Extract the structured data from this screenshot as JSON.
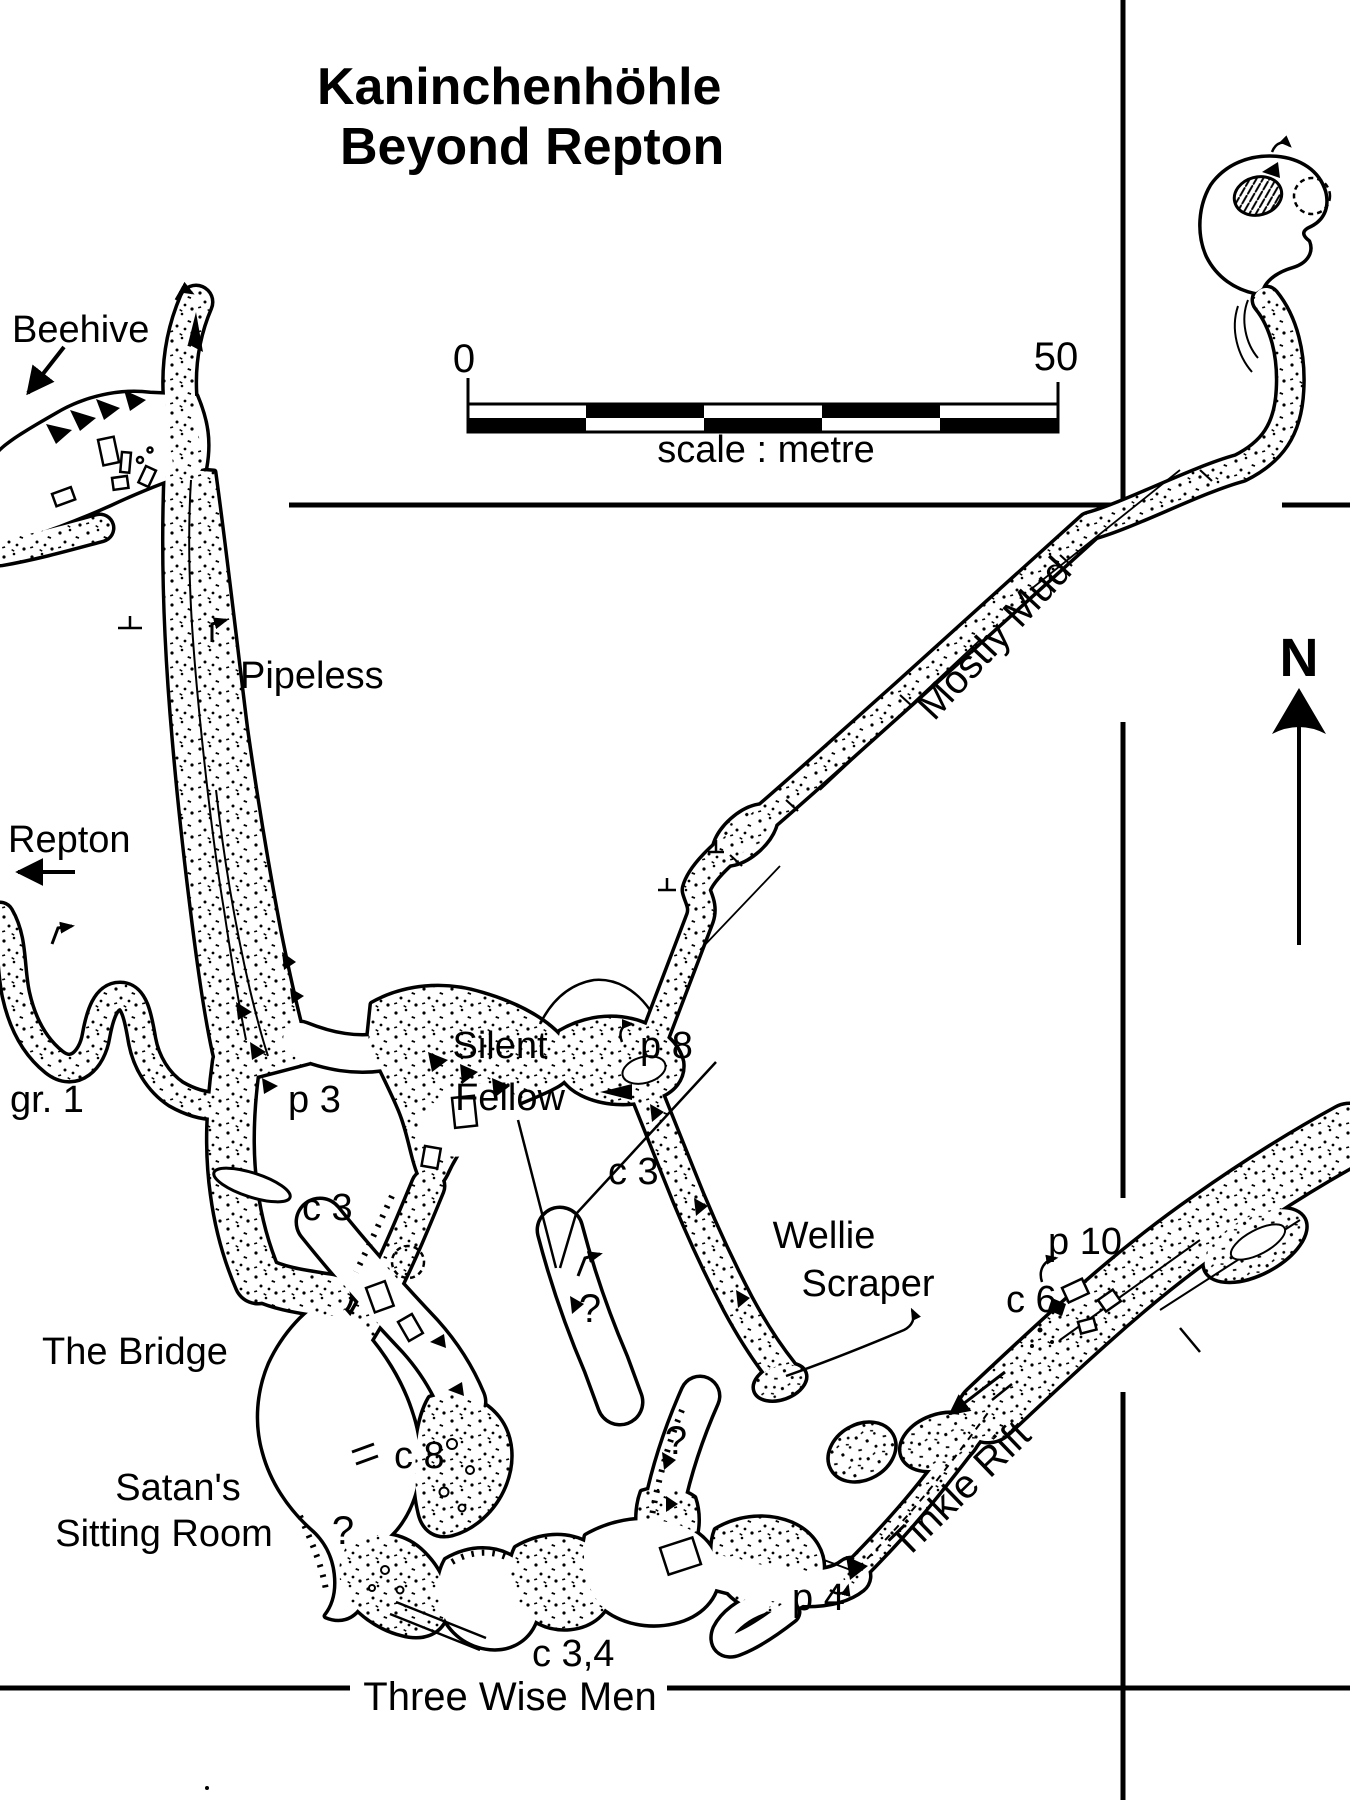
{
  "title": {
    "line1": "Kaninchenhöhle",
    "line2": "Beyond Repton"
  },
  "scale_bar": {
    "start": "0",
    "end": "50",
    "caption": "scale : metre"
  },
  "compass": {
    "label": "N"
  },
  "colors": {
    "ink": "#000000",
    "paper": "#ffffff"
  },
  "labels": {
    "beehive": "Beehive",
    "repton": "Repton",
    "pipeless": "Pipeless",
    "gr1": "gr. 1",
    "p3": "p 3",
    "c3_upper": "c 3",
    "silent_1": "Silent",
    "silent_2": "Fellow",
    "p8": "p 8",
    "c3_silent": "c 3",
    "mostly_mud": "Mostly Mud",
    "wellie_1": "Wellie",
    "wellie_2": "Scraper",
    "p10": "p 10",
    "c6": "c 6",
    "the_bridge": "The Bridge",
    "c8": "c 8",
    "satans_1": "Satan's",
    "satans_2": "Sitting Room",
    "tinkle_rift": "Tinkle Rift",
    "p4": "p 4",
    "c34": "c 3,4",
    "three_wise_men": "Three Wise Men",
    "q_satans": "?",
    "q_middle": "?",
    "q_wellie": "?"
  }
}
